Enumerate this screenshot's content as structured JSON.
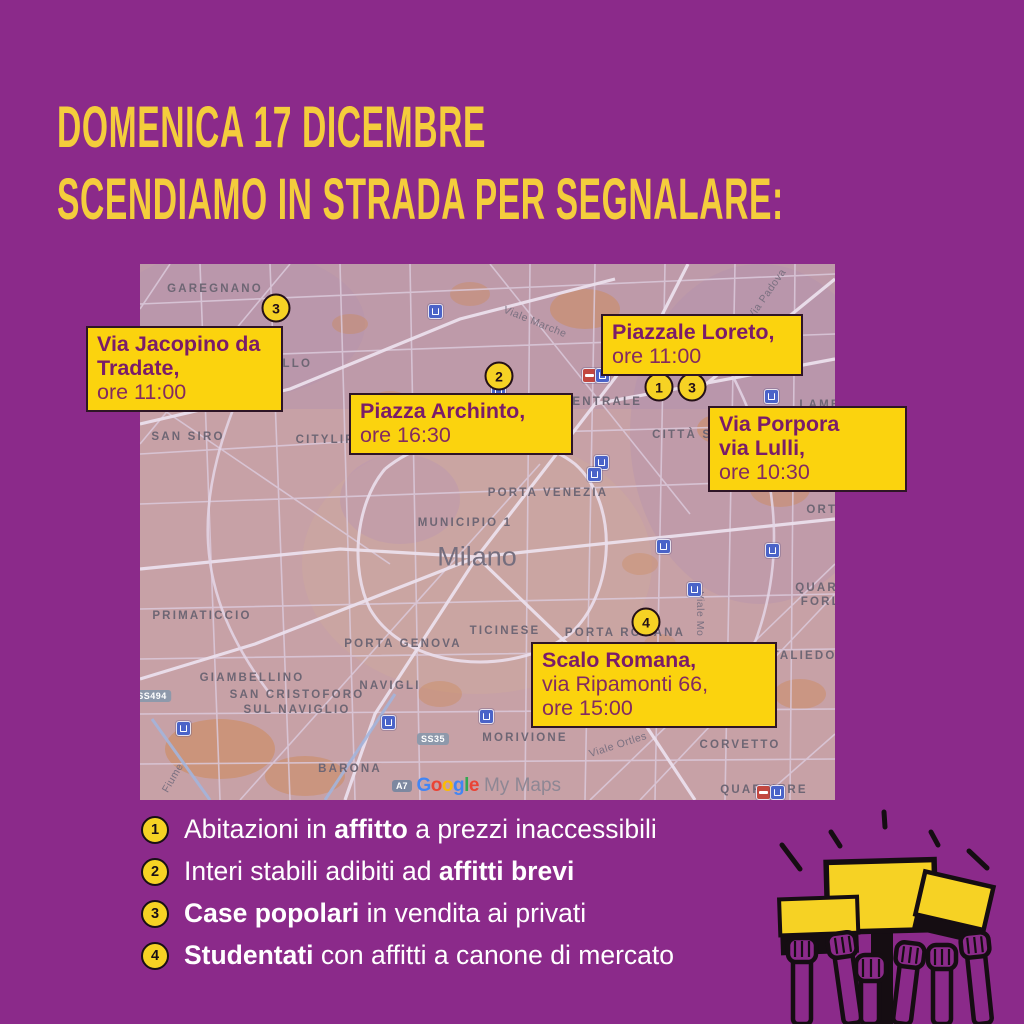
{
  "colors": {
    "background_purple": "#8B2A8A",
    "title_yellow": "#F4CD3C",
    "label_yellow": "#FBD30E",
    "label_text_purple": "#7A1C69",
    "map_base_pink": "#C7A1A6",
    "list_text_white": "#FFFFFF",
    "sign_yellow": "#F6D224",
    "ink_black": "#150D12"
  },
  "title": {
    "line1": "DOMENICA 17 DICEMBRE",
    "line2": "SCENDIAMO IN STRADA PER SEGNALARE:"
  },
  "map": {
    "area_labels": [
      {
        "t": "GAREGNANO",
        "x": 75,
        "y": 25,
        "k": "district"
      },
      {
        "t": "SAN SIRO",
        "x": 48,
        "y": 173,
        "k": "district"
      },
      {
        "t": "PORTELLO",
        "x": 132,
        "y": 100,
        "k": "district"
      },
      {
        "t": "CITYLIFE",
        "x": 190,
        "y": 176,
        "k": "district"
      },
      {
        "t": "PRIMATICCIO",
        "x": 62,
        "y": 352,
        "k": "district"
      },
      {
        "t": "GIAMBELLINO",
        "x": 112,
        "y": 414,
        "k": "district"
      },
      {
        "t": "SAN CRISTOFORO",
        "x": 157,
        "y": 431,
        "k": "district"
      },
      {
        "t": "SUL NAVIGLIO",
        "x": 157,
        "y": 446,
        "k": "district"
      },
      {
        "t": "NAVIGLI",
        "x": 250,
        "y": 422,
        "k": "district"
      },
      {
        "t": "PORTA GENOVA",
        "x": 263,
        "y": 380,
        "k": "district"
      },
      {
        "t": "TICINESE",
        "x": 365,
        "y": 367,
        "k": "district"
      },
      {
        "t": "PORTA ROMANA",
        "x": 485,
        "y": 369,
        "k": "district"
      },
      {
        "t": "MORIVIONE",
        "x": 385,
        "y": 474,
        "k": "district"
      },
      {
        "t": "CORVETTO",
        "x": 600,
        "y": 481,
        "k": "district"
      },
      {
        "t": "BARONA",
        "x": 210,
        "y": 505,
        "k": "district"
      },
      {
        "t": "QUARTIERE",
        "x": 624,
        "y": 526,
        "k": "district"
      },
      {
        "t": "MUNICIPIO 1",
        "x": 325,
        "y": 259,
        "k": "district"
      },
      {
        "t": "Milano",
        "x": 337,
        "y": 293,
        "k": "city"
      },
      {
        "t": "CENTRALE",
        "x": 462,
        "y": 138,
        "k": "district"
      },
      {
        "t": "CITTÀ STUDI",
        "x": 560,
        "y": 171,
        "k": "district"
      },
      {
        "t": "LAMBRATE",
        "x": 700,
        "y": 141,
        "k": "district"
      },
      {
        "t": "ORTICA",
        "x": 695,
        "y": 246,
        "k": "district"
      },
      {
        "t": "QUARTIERE",
        "x": 699,
        "y": 324,
        "k": "district"
      },
      {
        "t": "FORLANINI",
        "x": 702,
        "y": 338,
        "k": "district"
      },
      {
        "t": "PORTA VENEZIA",
        "x": 408,
        "y": 229,
        "k": "district"
      },
      {
        "t": "TALIEDO",
        "x": 664,
        "y": 392,
        "k": "district"
      },
      {
        "t": "Viale Marche",
        "x": 395,
        "y": 58,
        "r": 22,
        "k": "street"
      },
      {
        "t": "Via Padova",
        "x": 627,
        "y": 30,
        "r": -55,
        "k": "street"
      },
      {
        "t": "Viale Ortles",
        "x": 478,
        "y": 481,
        "r": -18,
        "k": "street"
      },
      {
        "t": "Viale Mo",
        "x": 560,
        "y": 350,
        "r": 90,
        "k": "street"
      },
      {
        "t": "Fiume",
        "x": 33,
        "y": 514,
        "r": -60,
        "k": "street"
      }
    ],
    "road_badges": [
      {
        "t": "SS494",
        "x": 12,
        "y": 432
      },
      {
        "t": "SS35",
        "x": 293,
        "y": 475
      }
    ],
    "attribution": {
      "badge": "A7",
      "google_letters": [
        "G",
        "o",
        "o",
        "g",
        "l",
        "e"
      ],
      "google_colors": [
        "#4285F4",
        "#EA4335",
        "#FBBC05",
        "#4285F4",
        "#34A853",
        "#EA4335"
      ],
      "suffix": "My Maps"
    },
    "metro_icons": [
      {
        "x": 294,
        "y": 46,
        "type": "metro"
      },
      {
        "x": 357,
        "y": 125,
        "type": "metro"
      },
      {
        "x": 448,
        "y": 110,
        "type": "rail"
      },
      {
        "x": 461,
        "y": 110,
        "type": "metro"
      },
      {
        "x": 460,
        "y": 197,
        "type": "metro"
      },
      {
        "x": 453,
        "y": 209,
        "type": "metro"
      },
      {
        "x": 630,
        "y": 131,
        "type": "metro"
      },
      {
        "x": 522,
        "y": 281,
        "type": "metro"
      },
      {
        "x": 631,
        "y": 285,
        "type": "metro"
      },
      {
        "x": 553,
        "y": 324,
        "type": "metro"
      },
      {
        "x": 42,
        "y": 463,
        "type": "metro"
      },
      {
        "x": 247,
        "y": 457,
        "type": "metro"
      },
      {
        "x": 345,
        "y": 451,
        "type": "metro"
      },
      {
        "x": 622,
        "y": 527,
        "type": "rail"
      },
      {
        "x": 636,
        "y": 527,
        "type": "metro"
      }
    ],
    "markers": [
      {
        "n": "3",
        "x": 136,
        "y": 44
      },
      {
        "n": "2",
        "x": 359,
        "y": 112
      },
      {
        "n": "1",
        "x": 519,
        "y": 123
      },
      {
        "n": "3",
        "x": 552,
        "y": 123
      },
      {
        "n": "4",
        "x": 506,
        "y": 358
      }
    ],
    "callouts": [
      {
        "id": "via-jacopino",
        "x": -54,
        "y": 62,
        "w": 197,
        "lines": [
          {
            "t": "Via Jacopino da",
            "b": true
          },
          {
            "t": "Tradate,",
            "b": true
          },
          {
            "t": "ore 11:00",
            "b": false
          }
        ]
      },
      {
        "id": "piazza-archinto",
        "x": 209,
        "y": 129,
        "w": 224,
        "lines": [
          {
            "t": "Piazza Archinto,",
            "b": true
          },
          {
            "t": "ore 16:30",
            "b": false
          }
        ]
      },
      {
        "id": "piazzale-loreto",
        "x": 461,
        "y": 50,
        "w": 202,
        "lines": [
          {
            "t": "Piazzale Loreto,",
            "b": true
          },
          {
            "t": "ore 11:00",
            "b": false
          }
        ]
      },
      {
        "id": "via-porpora",
        "x": 568,
        "y": 142,
        "w": 199,
        "lines": [
          {
            "t": "Via Porpora",
            "b": true
          },
          {
            "t": "via Lulli,",
            "b": true
          },
          {
            "t": "ore 10:30",
            "b": false
          }
        ]
      },
      {
        "id": "scalo-romana",
        "x": 391,
        "y": 378,
        "w": 246,
        "lines": [
          {
            "t": "Scalo Romana,",
            "b": true
          },
          {
            "t": "via Ripamonti 66,",
            "b": false
          },
          {
            "t": "ore 15:00",
            "b": false
          }
        ]
      }
    ]
  },
  "legend": {
    "items": [
      {
        "n": "1",
        "segments": [
          {
            "t": "Abitazioni in ",
            "b": false
          },
          {
            "t": "affitto",
            "b": true
          },
          {
            "t": " a prezzi inaccessibili",
            "b": false
          }
        ]
      },
      {
        "n": "2",
        "segments": [
          {
            "t": "Interi stabili adibiti ad ",
            "b": false
          },
          {
            "t": "affitti brevi",
            "b": true
          }
        ]
      },
      {
        "n": "3",
        "segments": [
          {
            "t": "Case popolari",
            "b": true
          },
          {
            "t": " in vendita ai privati",
            "b": false
          }
        ]
      },
      {
        "n": "4",
        "segments": [
          {
            "t": "Studentati",
            "b": true
          },
          {
            "t": " con affitti a canone di mercato",
            "b": false
          }
        ]
      }
    ]
  }
}
